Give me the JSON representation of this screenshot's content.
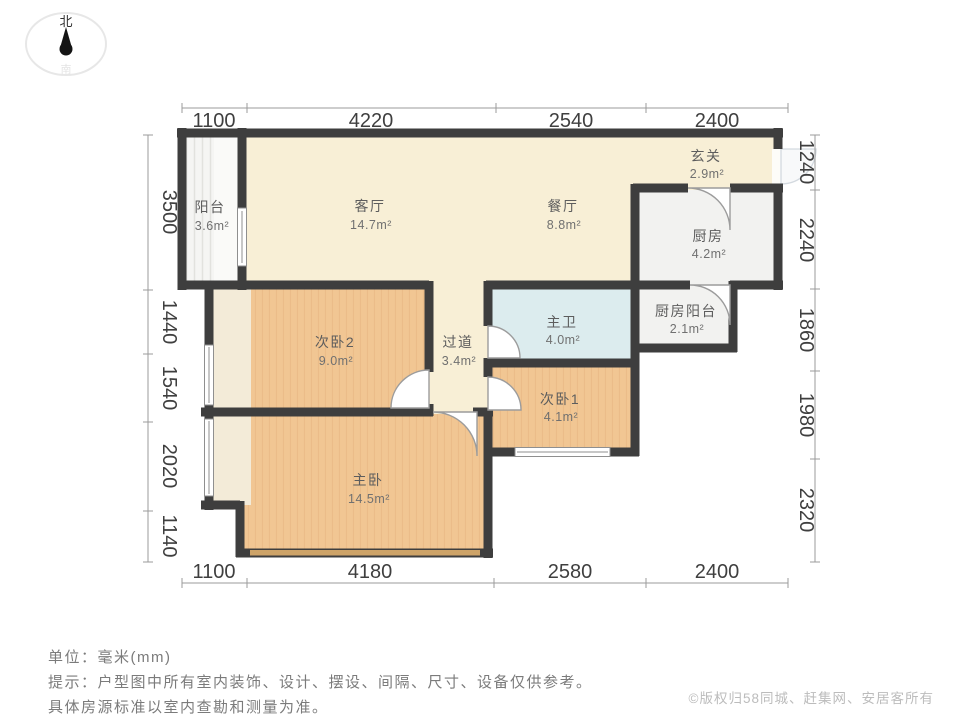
{
  "compass": {
    "north": "北",
    "south": "南"
  },
  "rooms": {
    "balcony": {
      "name": "阳台",
      "area": "3.6m²"
    },
    "living": {
      "name": "客厅",
      "area": "14.7m²"
    },
    "dining": {
      "name": "餐厅",
      "area": "8.8m²"
    },
    "foyer": {
      "name": "玄关",
      "area": "2.9m²"
    },
    "kitchen": {
      "name": "厨房",
      "area": "4.2m²"
    },
    "bedroom2": {
      "name": "次卧2",
      "area": "9.0m²"
    },
    "hallway": {
      "name": "过道",
      "area": "3.4m²"
    },
    "master_bath": {
      "name": "主卫",
      "area": "4.0m²"
    },
    "kitchen_balcony": {
      "name": "厨房阳台",
      "area": "2.1m²"
    },
    "bedroom1": {
      "name": "次卧1",
      "area": "4.1m²"
    },
    "master_bedroom": {
      "name": "主卧",
      "area": "14.5m²"
    }
  },
  "dimensions": {
    "top": [
      "1100",
      "4220",
      "2540",
      "2400"
    ],
    "bottom": [
      "1100",
      "4180",
      "2580",
      "2400"
    ],
    "left": [
      "3500",
      "1440",
      "1540",
      "2020",
      "1140"
    ],
    "right": [
      "1240",
      "2240",
      "1860",
      "1980",
      "2320"
    ]
  },
  "notes": {
    "unit": "单位：毫米(mm)",
    "tip_line1": "提示：户型图中所有室内装饰、设计、摆设、间隔、尺寸、设备仅供参考。",
    "tip_line2": "具体房源标准以室内查勘和测量为准。"
  },
  "copyright": "©版权归58同城、赶集网、安居客所有",
  "colors": {
    "wall": "#3e3e3e",
    "public_room": "#f8efd6",
    "bedroom_floor": "#f1c693",
    "bathroom": "#dcecee",
    "utility": "#f2f2f0",
    "bay_window": "#cda368",
    "dimension_text": "#3f3f3f"
  }
}
